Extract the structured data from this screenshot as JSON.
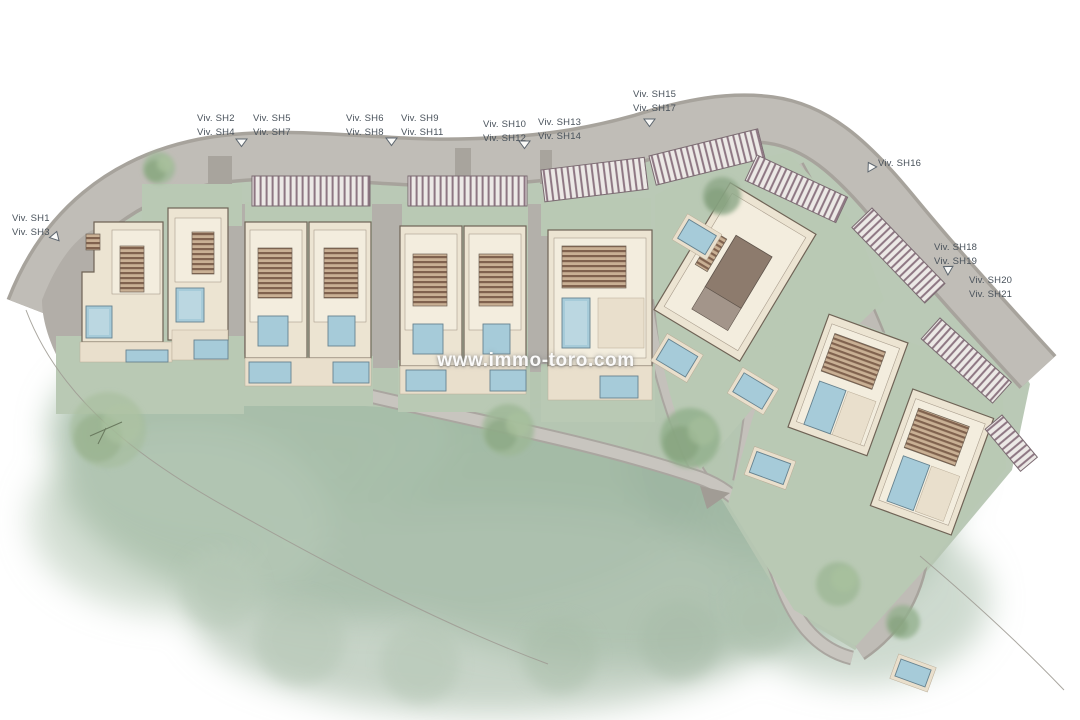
{
  "title": "residential development site plan",
  "watermark": {
    "text": "www.immo-toro.com"
  },
  "labels": [
    {
      "id": "sh1-sh3",
      "lines": [
        "Viv. SH1",
        "Viv. SH3"
      ]
    },
    {
      "id": "sh2-sh4",
      "lines": [
        "Viv. SH2",
        "Viv. SH4"
      ]
    },
    {
      "id": "sh5-sh7",
      "lines": [
        "Viv. SH5",
        "Viv. SH7"
      ]
    },
    {
      "id": "sh6-sh8",
      "lines": [
        "Viv. SH6",
        "Viv. SH8"
      ]
    },
    {
      "id": "sh9-sh11",
      "lines": [
        "Viv. SH9",
        "Viv. SH11"
      ]
    },
    {
      "id": "sh10-sh12",
      "lines": [
        "Viv. SH10",
        "Viv. SH12"
      ]
    },
    {
      "id": "sh13-sh14",
      "lines": [
        "Viv. SH13",
        "Viv. SH14"
      ]
    },
    {
      "id": "sh15-sh17",
      "lines": [
        "Viv. SH15",
        "Viv. SH17"
      ]
    },
    {
      "id": "sh16",
      "lines": [
        "Viv. SH16"
      ]
    },
    {
      "id": "sh18-sh19",
      "lines": [
        "Viv. SH18",
        "Viv. SH19"
      ]
    },
    {
      "id": "sh20-sh21",
      "lines": [
        "Viv. SH20",
        "Viv. SH21"
      ]
    }
  ],
  "icons": {
    "plot_marker": "triangle-outline"
  },
  "colors": {
    "road": "#c0bdb7",
    "road_edge": "#a7a39c",
    "garden": "#b9c9b4",
    "wash_green": "#9cb5a0",
    "roof": "#ece4d2",
    "roof_inner": "#f3edde",
    "outline": "#6f6356",
    "pool": "#a6cbd9",
    "pool_edge": "#66828f",
    "label_text": "#49525b"
  }
}
